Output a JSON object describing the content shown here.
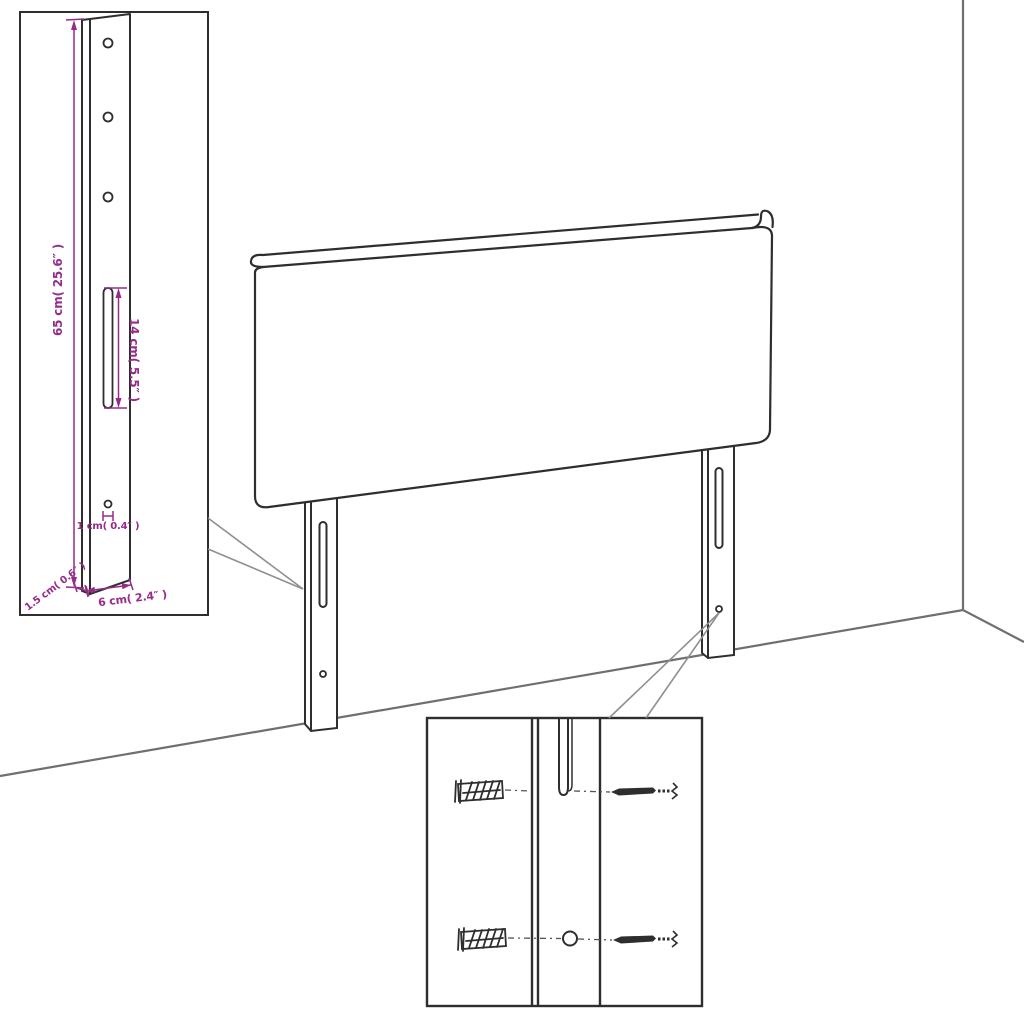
{
  "colors": {
    "background": "#ffffff",
    "outline": "#2e2e2e",
    "wall": "#6f6f6f",
    "pointer": "#8f8f8f",
    "dimension": "#962c88",
    "hardware": "#2e2e2e",
    "leader": "#555555"
  },
  "bracket_detail": {
    "dim_height": "65 cm( 25.6″ )",
    "dim_slot_length": "14 cm( 5.5″ )",
    "dim_hole_diameter": "1 cm( 0.4″ )",
    "dim_thickness": "1.5 cm( 0.6″ )",
    "dim_width": "6 cm( 2.4″ )"
  }
}
